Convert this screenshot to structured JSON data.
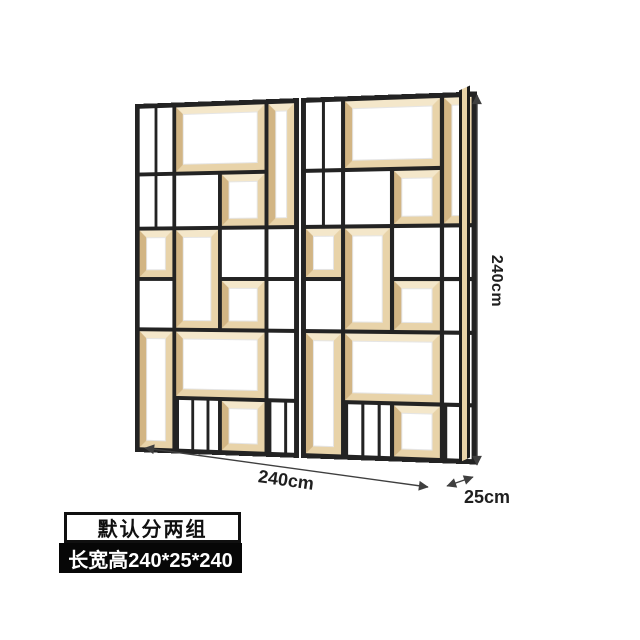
{
  "dimensions": {
    "height_label": "240cm",
    "width_label": "240cm",
    "depth_label": "25cm"
  },
  "badges": {
    "group_note": "默认分两组",
    "size_note": "长宽高240*25*240"
  },
  "shelf": {
    "groups": 2,
    "colors": {
      "frame": "#232323",
      "wood": "#e8d3a9",
      "wood_shadow": "#d2b584",
      "wood_highlight": "#f4e7ca",
      "back": "#ffffff"
    },
    "module": {
      "columns": [
        "0.95fr",
        "1.2fr",
        "1.2fr",
        "0.72fr"
      ],
      "rows": [
        "66px",
        "52px",
        "48px",
        "48px",
        "66px",
        "50px"
      ],
      "cells": [
        {
          "r": 1,
          "c": 1,
          "type": "split"
        },
        {
          "r": 1,
          "c": 2,
          "cs": 2,
          "type": "wood"
        },
        {
          "r": 1,
          "c": 4,
          "rs": 2,
          "type": "wood"
        },
        {
          "r": 2,
          "c": 1,
          "type": "split"
        },
        {
          "r": 2,
          "c": 2,
          "type": "open"
        },
        {
          "r": 2,
          "c": 3,
          "type": "wood"
        },
        {
          "r": 3,
          "c": 1,
          "type": "wood"
        },
        {
          "r": 3,
          "c": 2,
          "rs": 2,
          "type": "wood"
        },
        {
          "r": 3,
          "c": 3,
          "type": "open"
        },
        {
          "r": 3,
          "c": 4,
          "type": "open"
        },
        {
          "r": 4,
          "c": 1,
          "type": "open"
        },
        {
          "r": 4,
          "c": 3,
          "type": "wood"
        },
        {
          "r": 4,
          "c": 4,
          "type": "open"
        },
        {
          "r": 5,
          "c": 1,
          "rs": 2,
          "type": "wood"
        },
        {
          "r": 5,
          "c": 2,
          "cs": 2,
          "type": "wood"
        },
        {
          "r": 5,
          "c": 4,
          "type": "open"
        },
        {
          "r": 6,
          "c": 2,
          "type": "bars"
        },
        {
          "r": 6,
          "c": 3,
          "type": "wood"
        },
        {
          "r": 6,
          "c": 4,
          "type": "bars"
        }
      ]
    }
  }
}
